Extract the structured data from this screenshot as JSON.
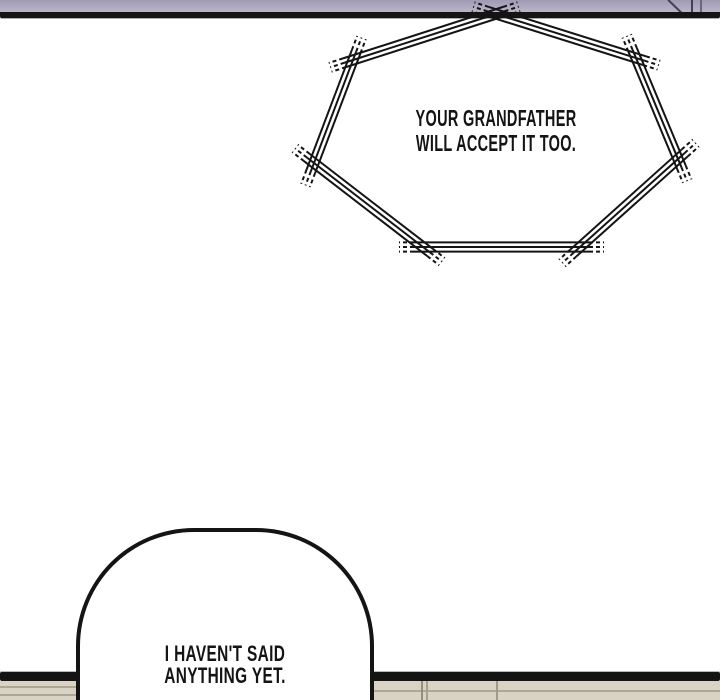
{
  "speech_bubbles": {
    "jagged": {
      "line1": "YOUR GRANDFATHER",
      "line2": "WILL ACCEPT IT TOO."
    },
    "rounded": {
      "line1": "I HAVEN'T SAID",
      "line2": "ANYTHING YET."
    }
  },
  "colors": {
    "ink": "#141414",
    "page_bg": "#ffffff",
    "band_top": "#a09ab4",
    "band_bottom": "#b9b5c9",
    "wall_beige": "#d8d3c4",
    "wall_line": "#aea794"
  }
}
